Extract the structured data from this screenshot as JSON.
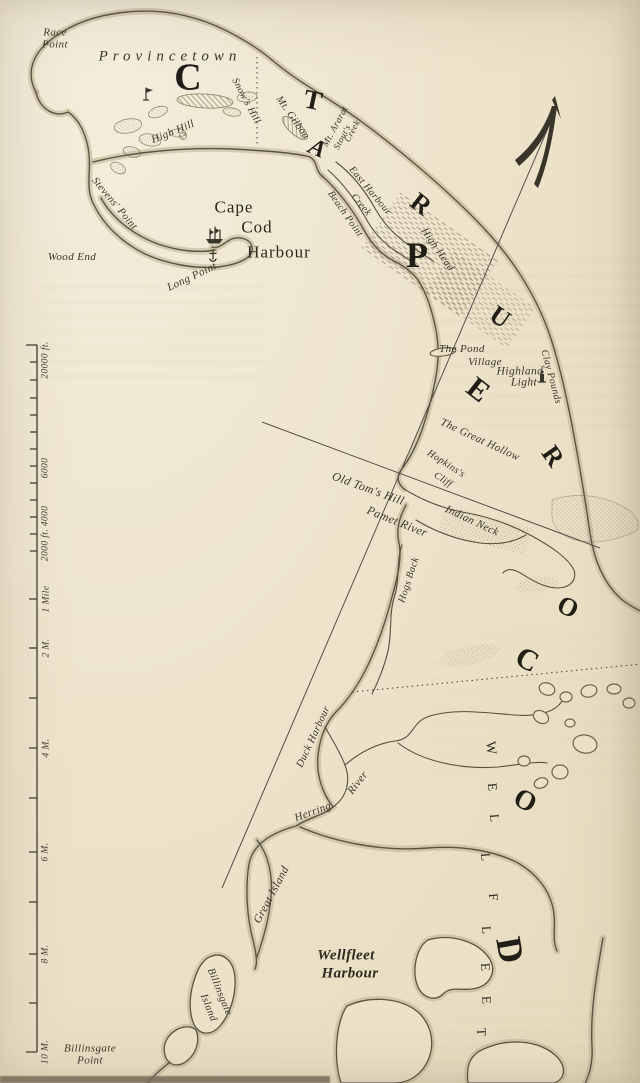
{
  "map": {
    "paper_color": "#eee4cc",
    "ink_color": "#3a352b",
    "coast_color": "#5a5444",
    "band_color": "#bcb092"
  },
  "labels": {
    "race_point": "Race\nPoint",
    "provincetown": "Provincetown",
    "snows_hill": "Snow's Hill",
    "mt_gilboa": "Mt. Gilboa",
    "mt_ararat": "Mt. Ararat",
    "stouts": "Stout's",
    "creek_stouts": "Creek",
    "high_hill": "High Hill",
    "stevens_point": "Stevens' Point",
    "wood_end": "Wood End",
    "long_point": "Long Point",
    "cape": "Cape",
    "cod": "Cod",
    "harbour": "Harbour",
    "east_harbour": "East Harbour",
    "creek_east": "Creek",
    "beach_point": "Beach Point",
    "high_head": "High Head",
    "the_pond": "The Pond",
    "village": "Village",
    "highland": "Highland",
    "light": "Light",
    "clay_pounds": "Clay Pounds",
    "great_hollow": "The Great Hollow",
    "hopkinss": "Hopkins's",
    "cliff": "Cliff",
    "old_toms_hill": "Old Tom's Hill",
    "pamet_river": "Pamet River",
    "indian_neck": "Indian Neck",
    "hogs_back": "Hogs Back",
    "duck_harbour": "Duck Harbour",
    "herring": "Herring",
    "river": "River",
    "great_island": "Great Island",
    "wellfleet_harbour_l1": "Wellfleet",
    "wellfleet_harbour_l2": "Harbour",
    "billinsgate": "Billinsgate",
    "island": "Island",
    "billinsgate_point": "Billinsgate\nPoint"
  },
  "letters": [
    "C",
    "T",
    "A",
    "R",
    "P",
    "U",
    "E",
    "R",
    "O",
    "C",
    "O",
    "D"
  ],
  "wellfleet_letters": [
    "W",
    "E",
    "L",
    "L",
    "F",
    "L",
    "E",
    "E",
    "T"
  ],
  "scale": {
    "labels": [
      "20000 ft.",
      "6000",
      "4000",
      "2000 ft.",
      "1 Mile",
      "2 M.",
      "4 M.",
      "6 M.",
      "8 M.",
      "10 M."
    ]
  },
  "icons": {
    "ship": "sailing-ship-icon",
    "lighthouse_race_point": "lighthouse-icon",
    "lighthouse_highland": "lighthouse-icon",
    "north_arrow": "north-arrow-icon",
    "anchorage": "anchorage-mark-icon"
  }
}
